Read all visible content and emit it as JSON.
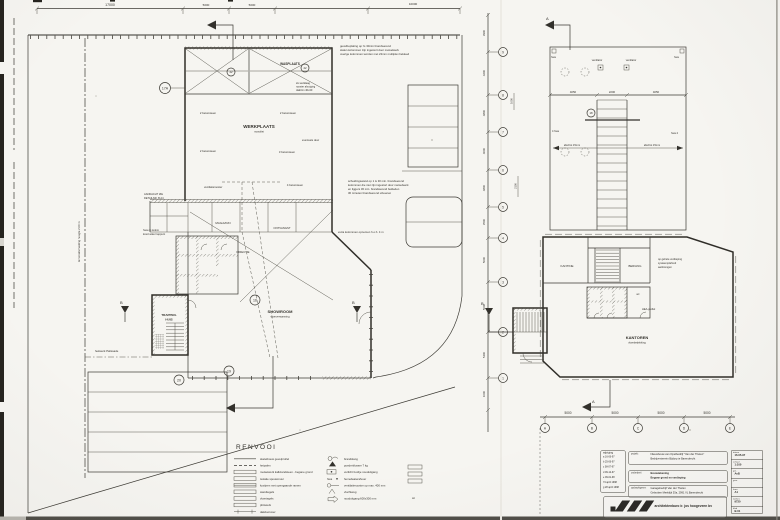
{
  "sheet": {
    "paper": "#f6f5f1",
    "ink": "#33312c"
  },
  "left_plan": {
    "top_dims": [
      "17000",
      "5000",
      "5000",
      "10000"
    ],
    "rooms": {
      "werkplaats": "WERKPLAATS",
      "werkplaats_sub": "monoliet",
      "wasplaats": "WASPLAATS",
      "magazijn": "MAGAZIJN",
      "ontvangst": "ONTVANGST",
      "directie": "DIRECTIE",
      "showroom": "SHOWROOM",
      "showroom_sub": "vloerverwarming",
      "trappenhuis_1": "TRAPPEN-",
      "trappenhuis_2": "HUIS"
    },
    "wall_labels": [
      "2 betonsteen",
      "2 betonsteen",
      "2 betonsteen",
      "3 betonsteen",
      "4 betonsteen"
    ],
    "small_labels": {
      "eventuele_deur": "eventuele deur",
      "vent": "ventilatierooster",
      "hekwerk": "hekwerk Palissade",
      "terrein": "terreinafscheiding hoogte 2.00 m",
      "aandacht_1": "AANDACHT ZIE",
      "aandacht_2": "DETAILNR. B A4",
      "hwa_1": "hwa op kolom",
      "hwa_2": "koud water tappunt"
    },
    "note_gevel": [
      "gevelbeplating op t's 30min brandwerend",
      "stalen kolommen zijn ingestort door metselwerk",
      "overige kolommen worden met 22mm multiplex bekleed"
    ],
    "note_wasplaats": [
      "2e werklaag",
      "rooster afzuiging",
      "daktrim 40x40"
    ],
    "note_scheiding": [
      "scheidingswand op 1 is 30 min. brandwerend",
      "kolommen die niet zijn ingestort door metselwerk",
      "en liggers 30 min. brandwerend bekleden",
      "30 minuten brandwerend uitvoeren"
    ],
    "note_extra": "extra kolommen opnemen  h.o.h. 4 m",
    "bubbles": [
      "17A",
      "22",
      "22",
      "16",
      "19",
      "20"
    ]
  },
  "grid_chain": {
    "dims": [
      "3900",
      "4200",
      "4800",
      "4000",
      "4800",
      "3500",
      "5000",
      "5000",
      "5400",
      "1000"
    ],
    "bubbles": [
      "9",
      "8",
      "7",
      "6",
      "5",
      "4",
      "3",
      "2",
      "1"
    ],
    "extra_dims": [
      "1000",
      "2100"
    ],
    "section_b": "B"
  },
  "right_plan": {
    "roof_dims": [
      "4050",
      "2200",
      "4050"
    ],
    "ventilator_1": "ventilator",
    "ventilator_2": "ventilator",
    "hwa_tl": "hwa",
    "hwa_tr": "hwa",
    "hwa_l": "4 hwa",
    "hwa_r": "hwa 4",
    "afschot_l": "afschot 15mm",
    "afschot_r": "afschot 15mm",
    "detail_bubble": "18",
    "rooms": {
      "kantine": "KANTINE",
      "berging": "BERGING",
      "wc": "wc",
      "kantoren": "KANTOREN",
      "kantoren_sub": "vloerbedekking"
    },
    "note": [
      "op gehele verdieping",
      "systeemplafond",
      "aanbrengen"
    ],
    "hea": "HEA-profiel",
    "section_a": "A",
    "bottom_dims": [
      "5000",
      "5000",
      "5000",
      "5000"
    ],
    "bottom_bubbles": [
      "A",
      "B",
      "C",
      "D",
      "E"
    ]
  },
  "legend": {
    "title": "RENVOOI",
    "left_items": [
      "skeletbouw gevelprofiel",
      "heipalen",
      "metselwerk kalkzandsteen - begane grond",
      "isolatie spouwmuur",
      "kozijnen met opengaande ramen",
      "wandtegels",
      "vloertegels",
      "plintwerk",
      "dakdoorvoer"
    ],
    "right_items": [
      "brandslang",
      "poederblusser 7 kg",
      "verlicht bordje nooduitgang",
      "hemelwaterafvoer",
      "ventilatierooster op max. 400 mm",
      "vluchtweg",
      "nooduitgang 600x300 mm"
    ],
    "sym_hwa": "hwa",
    "wt": "wt"
  },
  "titleblock": {
    "wijziging_title": "wijziging",
    "wijziging_rows": [
      "a  16-06-97",
      "b  25-06-97",
      "c  08-07-97",
      "d  09-12-97",
      "e  09-01-98",
      "f  9 april 1998",
      "g  28 april 1998"
    ],
    "project_label": "projekt:",
    "project_line1": "Nieuwbouw van Opelbedrijf \"Van der Thelen\"",
    "project_line2": "Bedrijventerrein Bijdorp te Barendrecht",
    "onderdeel_label": "onderdeel:",
    "onderdeel_line1": "Bouwtekening",
    "onderdeel_line2": "Begane grond en verdieping",
    "opdrachtgever_label": "opdrachtgever:",
    "opdrachtgever_line1": "Garagebedrijf Van der Thelen",
    "opdrachtgever_line2": "Gebroken Meeldijk 53a, 2991 VL Barendrecht",
    "firm": "architektenburo ir. jos hoogeveen bv",
    "fields": [
      {
        "label": "datum",
        "value": "16-05-97"
      },
      {
        "label": "schaal",
        "value": "1:100"
      },
      {
        "label": "get.",
        "value": "AvB"
      },
      {
        "label": "gew.",
        "value": ""
      },
      {
        "label": "form.",
        "value": "A1"
      },
      {
        "label": "werknr.",
        "value": "9720"
      },
      {
        "label": "blad",
        "value": "B.01"
      }
    ]
  }
}
